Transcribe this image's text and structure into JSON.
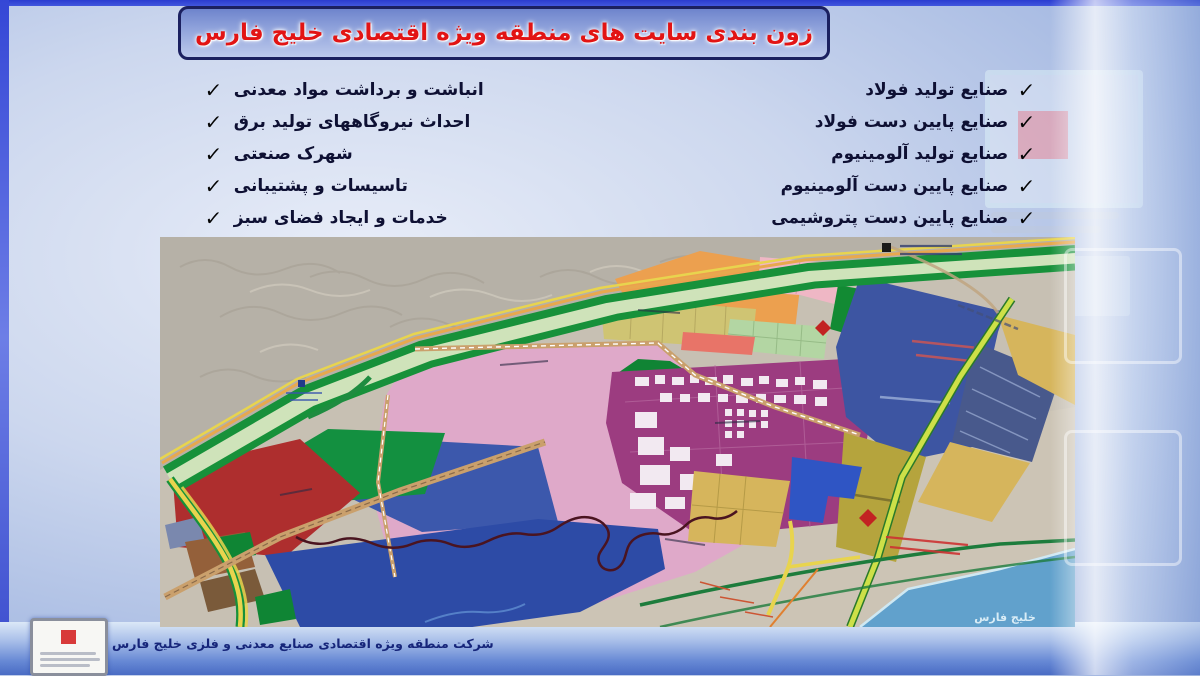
{
  "title": "زون بندی سایت های منطقه ویژه اقتصادی خلیج فارس",
  "check": "✓",
  "left_list": {
    "items": [
      "انباشت و برداشت مواد معدنی",
      "احداث نیروگاههای تولید برق",
      "شهرک صنعتی",
      "تاسیسات و پشتیبانی",
      "خدمات و ایجاد فضای سبز"
    ]
  },
  "right_list": {
    "items": [
      "صنایع تولید فولاد",
      "صنایع پایین دست فولاد",
      "صنایع تولید آلومینیوم",
      "صنایع پایین دست آلومینیوم",
      "صنایع پایین دست پتروشیمی"
    ]
  },
  "map": {
    "sea_label": "خلیج فارس",
    "palette": {
      "terrain": "#c7c0b3",
      "mountain": "#b6b1a7",
      "pink": "#dfa9c9",
      "purple": "#9c3c80",
      "dark_blue": "#3d55a2",
      "hatched_blue": "#48598c",
      "bright_blue": "#2f55c4",
      "blue_lower": "#2d4ba6",
      "blue_upper": "#3c58ac",
      "orange": "#eca04f",
      "khaki": "#cfc473",
      "mustard": "#d6b55c",
      "olive": "#b5a43d",
      "green": "#17913a",
      "light_green": "#b3d6a3",
      "red": "#ae2e2e",
      "salmon": "#e87468",
      "light_pink": "#efb7c5",
      "brown": "#94603a",
      "sea": "#61a1cc",
      "road_yellow": "#e8d44e",
      "road_chartreuse": "#cde048",
      "road_tan": "#caa06c"
    }
  },
  "footer": {
    "company": "شرکت منطقه ویژه اقتصادی صنایع معدنی و فلزی خلیج فارس"
  },
  "colors": {
    "title_red": "#e21414",
    "frame_blue": "#2a3cd0",
    "footer_text": "#16257a"
  }
}
